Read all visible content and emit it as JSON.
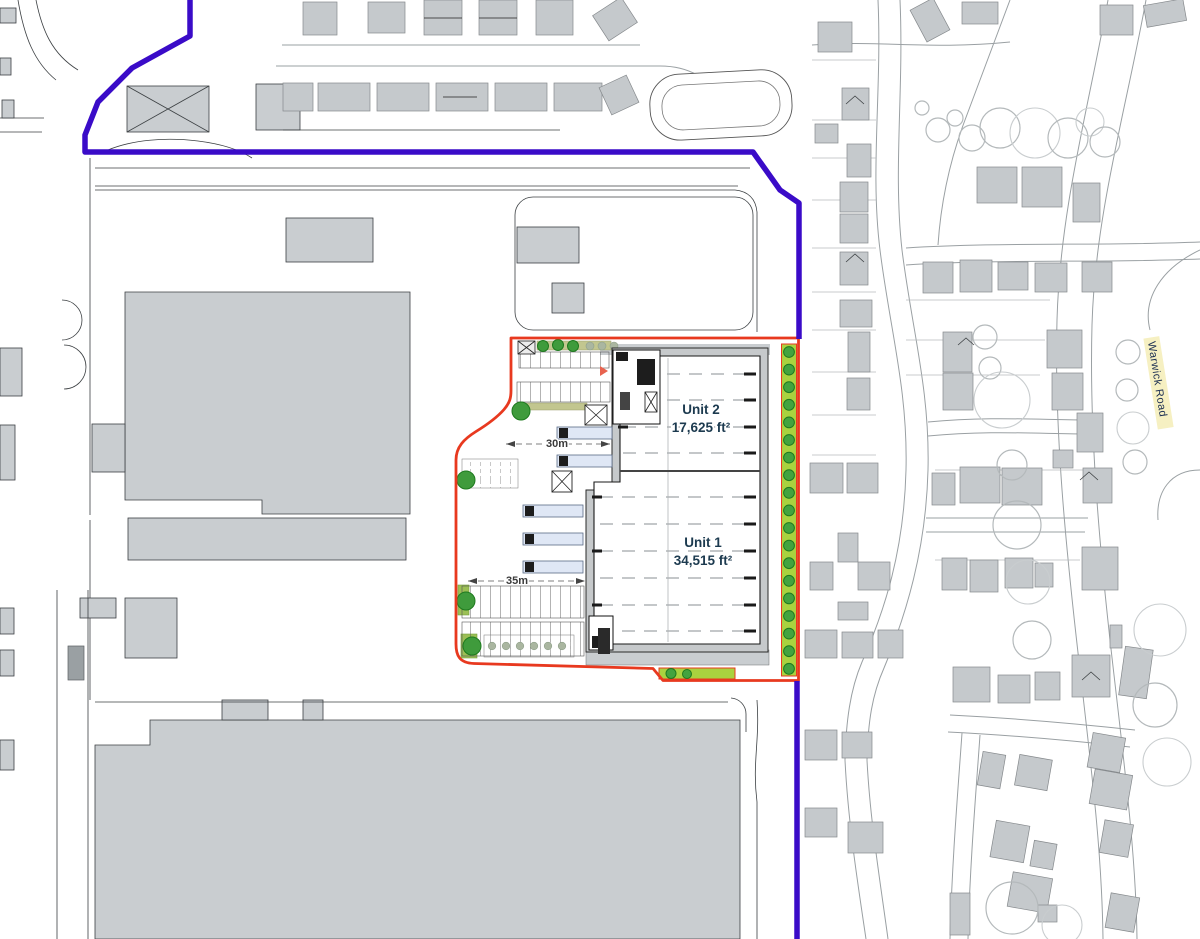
{
  "colors": {
    "boundary-blue": "#3a0bc8",
    "boundary-red": "#e8391f",
    "hedge-green": "#a9d23f",
    "tree-green": "#3f9b3c",
    "building-gray": "#c9cdd0",
    "house-gray": "#c5c9cc",
    "canopy-blue": "#dfe7f5",
    "road-line": "#9aa0a3",
    "highlight-yellow": "#f6f0c2",
    "label-navy": "#1c3a4f"
  },
  "site_plan": {
    "units": [
      {
        "label": "Unit 2",
        "area": "17,625 ft²"
      },
      {
        "label": "Unit 1",
        "area": "34,515 ft²"
      }
    ],
    "dimensions": {
      "north_yard": "30m",
      "south_yard": "35m"
    },
    "road_label": "Warwick Road"
  }
}
